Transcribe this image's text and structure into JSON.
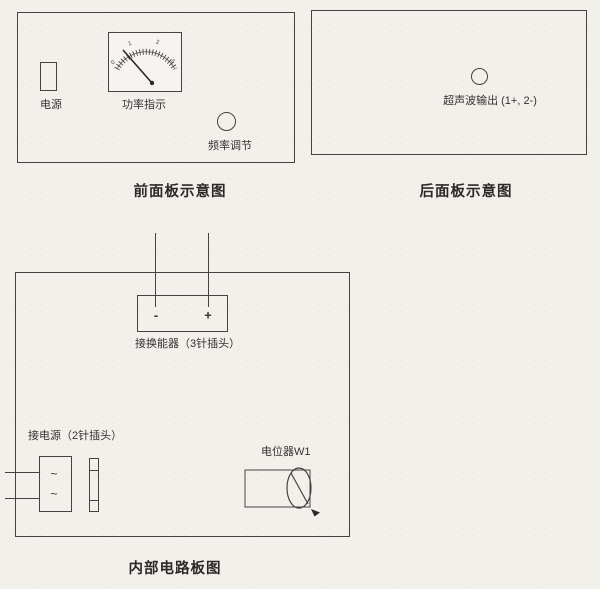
{
  "page": {
    "colors": {
      "paper": "#f2f0eb",
      "line": "#454341",
      "text": "#353331"
    }
  },
  "front_panel": {
    "caption": "前面板示意图",
    "power_switch_label": "电源",
    "meter_label": "功率指示",
    "meter_scale": [
      "0",
      "1",
      "2",
      "3"
    ],
    "freq_knob_label": "频率调节"
  },
  "back_panel": {
    "caption": "后面板示意图",
    "output_label": "超声波输出 (1+, 2-)"
  },
  "board": {
    "caption": "内部电路板图",
    "transducer_label": "接换能器（3针插头）",
    "transducer_minus": "-",
    "transducer_plus": "+",
    "power_label": "接电源（2针插头）",
    "ac_mark": "~",
    "pot_label": "电位器W1"
  }
}
